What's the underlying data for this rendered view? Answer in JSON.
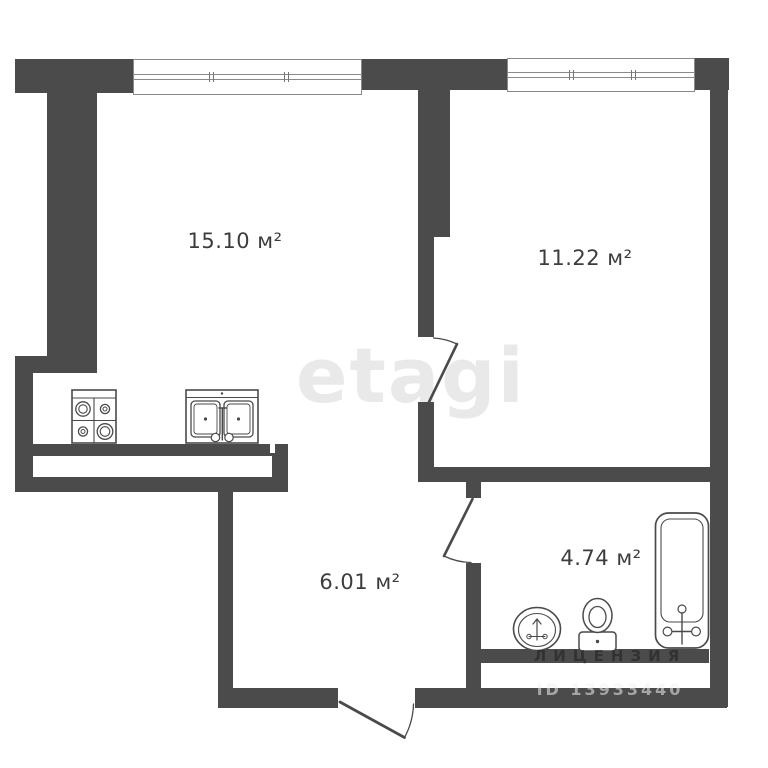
{
  "title": "Однокомнатная квартира — план",
  "rooms": [
    {
      "id": "living-room",
      "label": "15.10 м²",
      "area": "15.10",
      "unit": "м²"
    },
    {
      "id": "bedroom",
      "label": "11.22 м²",
      "area": "11.22",
      "unit": "м²"
    },
    {
      "id": "hallway",
      "label": "6.01 м²",
      "area": "6.01",
      "unit": "м²"
    },
    {
      "id": "bathroom",
      "label": "4.74 м²",
      "area": "4.74",
      "unit": "м²"
    }
  ],
  "watermarks": {
    "brand": "etagi",
    "license_line": "ЛИЦЕНЗИЯ",
    "id_line": "ID 13933440"
  },
  "fixtures": [
    "stove-icon",
    "kitchen-sink-icon",
    "bathtub-icon",
    "toilet-icon",
    "washbasin-icon"
  ],
  "colors": {
    "wall": "#4b4b4b",
    "fixture_outline": "#4a4a4a",
    "window_frame": "#8a8a8a",
    "background": "#ffffff",
    "label_text": "#3c3c3c",
    "brand_watermark": "#e9e9e9"
  }
}
